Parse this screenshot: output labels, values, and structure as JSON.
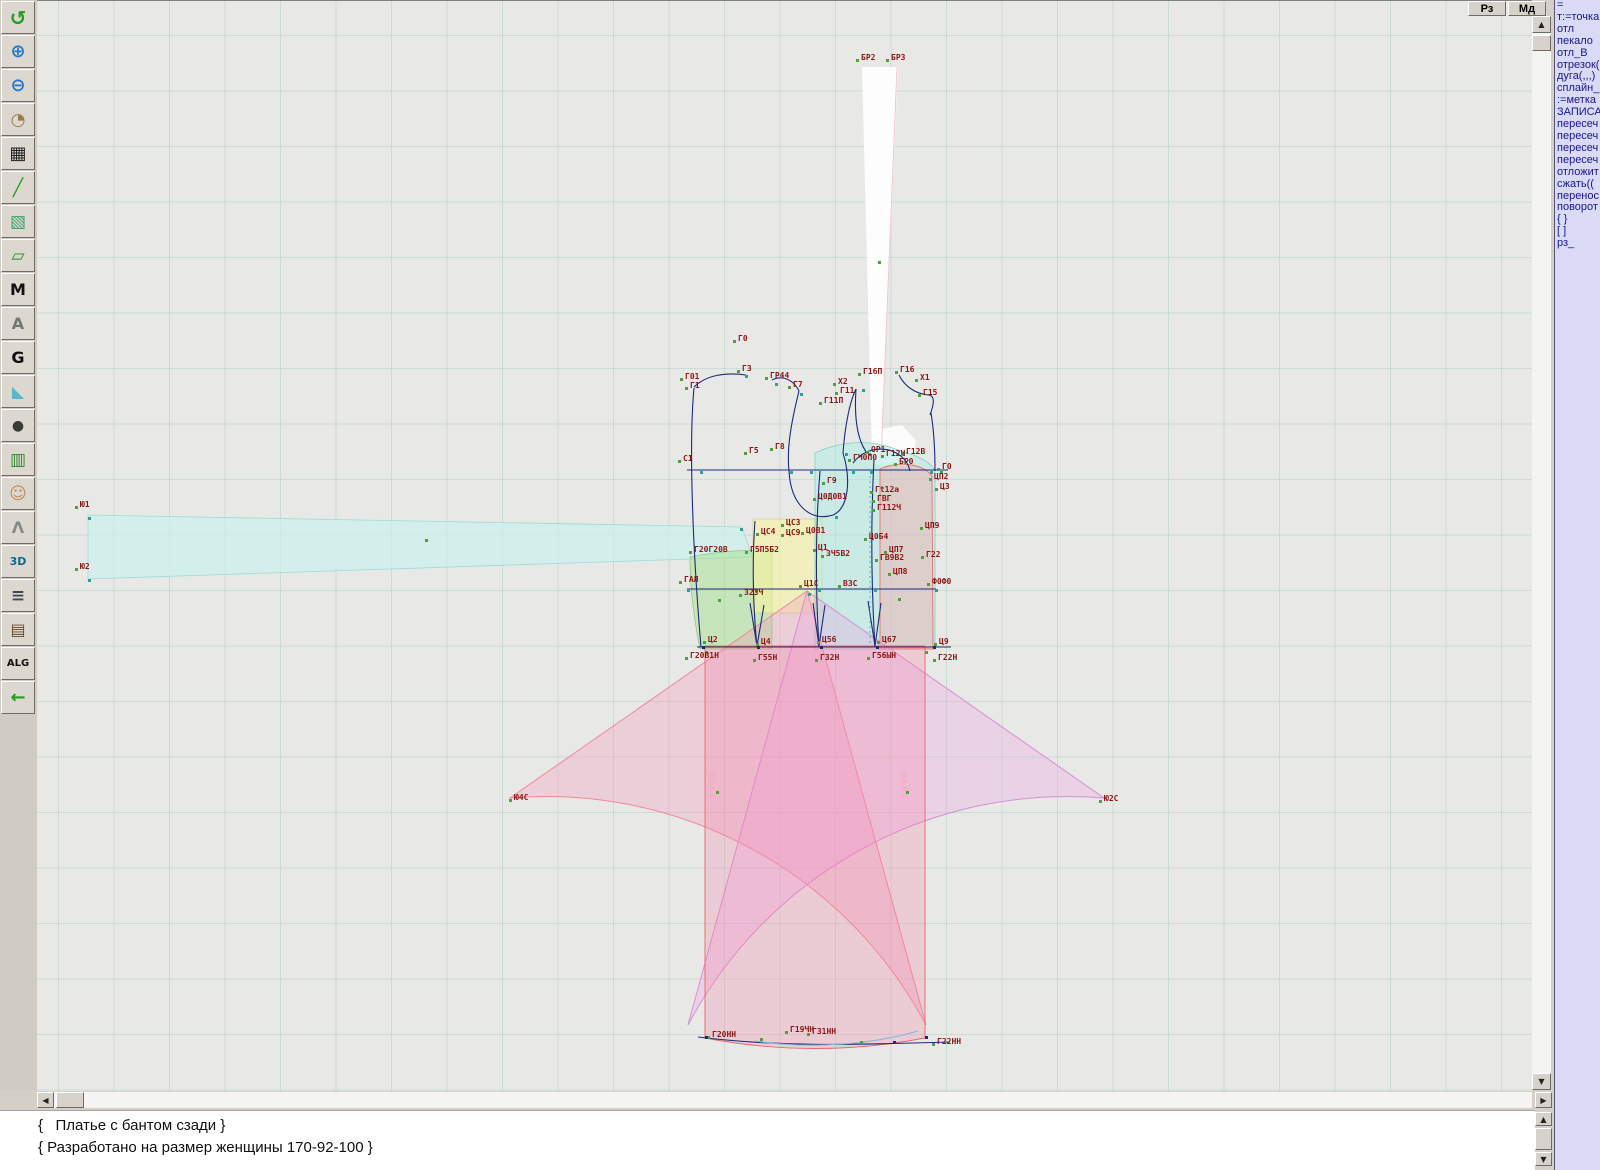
{
  "window": {
    "mode_buttons": [
      {
        "label": "Рз"
      },
      {
        "label": "Мд"
      }
    ]
  },
  "toolbar": {
    "items": [
      {
        "name": "refresh-icon",
        "glyph": "↺",
        "fg": "#1f9e1f",
        "size": 20
      },
      {
        "name": "zoom-in-icon",
        "glyph": "⊕",
        "fg": "#2277cc",
        "size": 18
      },
      {
        "name": "zoom-out-icon",
        "glyph": "⊖",
        "fg": "#2277cc",
        "size": 18
      },
      {
        "name": "zoom-piece-icon",
        "glyph": "◔",
        "fg": "#9a7b4f",
        "size": 17
      },
      {
        "name": "grid-icon",
        "glyph": "▦",
        "fg": "#222222",
        "size": 18
      },
      {
        "name": "measure-line-icon",
        "glyph": "╱",
        "fg": "#1f9e1f",
        "size": 17
      },
      {
        "name": "image-icon",
        "glyph": "▧",
        "fg": "#3aa06a",
        "size": 17
      },
      {
        "name": "pattern-piece-icon",
        "glyph": "▱",
        "fg": "#2a8a2a",
        "size": 17
      },
      {
        "name": "pattern-m-icon",
        "glyph": "M",
        "fg": "#111111",
        "size": 16
      },
      {
        "name": "compass-icon",
        "glyph": "A",
        "fg": "#777777",
        "size": 16
      },
      {
        "name": "g-tool-icon",
        "glyph": "G",
        "fg": "#111111",
        "size": 16
      },
      {
        "name": "ruler-icon",
        "glyph": "◣",
        "fg": "#58b8c8",
        "size": 16
      },
      {
        "name": "camera-icon",
        "glyph": "●",
        "fg": "#3a3a3a",
        "size": 14
      },
      {
        "name": "table-icon",
        "glyph": "▥",
        "fg": "#2a8a2a",
        "size": 17
      },
      {
        "name": "model-photo-icon",
        "glyph": "☺",
        "fg": "#c08a5a",
        "size": 17
      },
      {
        "name": "garment-icon",
        "glyph": "Λ",
        "fg": "#888888",
        "size": 16
      },
      {
        "name": "view-3d-icon",
        "glyph": "3D",
        "fg": "#0a6a8a",
        "size": 11
      },
      {
        "name": "text-list-icon",
        "glyph": "≡",
        "fg": "#444455",
        "size": 17
      },
      {
        "name": "books-icon",
        "glyph": "▤",
        "fg": "#6a4a2a",
        "size": 16
      },
      {
        "name": "alg-doc-icon",
        "glyph": "ALG",
        "fg": "#111111",
        "size": 10
      },
      {
        "name": "exit-icon",
        "glyph": "←",
        "fg": "#1f9e1f",
        "size": 18
      }
    ]
  },
  "command_panel": {
    "items": [
      "=",
      "т:=точка",
      "отл",
      "пекало",
      "отл_В",
      "отрезок(",
      "дуга(,,,)",
      "сплайн_",
      ":=метка",
      "ЗАПИСА",
      "пересеч",
      "пересеч",
      "пересеч",
      "пересеч",
      "отложит",
      "сжать((",
      "перенос",
      "поворот",
      "{ }",
      "[ ]",
      "рз_"
    ]
  },
  "statusbar": {
    "lines": [
      "{   Платье с бантом сзади }",
      "{ Разработано на размер женщины 170-92-100 }"
    ]
  },
  "canvas": {
    "colors": {
      "band_fill": "rgba(205,240,236,0.75)",
      "band_stroke": "#9adcd4",
      "green_fill": "rgba(160,225,130,0.45)",
      "green_stroke": "#8cc87c",
      "yellow_fill": "rgba(246,244,160,0.60)",
      "yellow_stroke": "#d8d28a",
      "cyan_fill": "rgba(175,235,228,0.55)",
      "cyan_stroke": "#88ccc4",
      "salmon_fill": "rgba(250,165,165,0.40)",
      "salmon_stroke": "#e87070",
      "fan_left_fill": "rgba(244,150,185,0.32)",
      "fan_left_stroke": "#ee8898",
      "fan_right_fill": "rgba(235,160,225,0.30)",
      "fan_right_stroke": "#d88ed0",
      "skirt_band_fill": "rgba(248,130,165,0.28)",
      "skirt_band_stroke": "#e86868",
      "outline": "#1c2a78",
      "white_piece": "#ffffff",
      "label_color": "#8c1616",
      "marker_green": "#4f9f3f",
      "marker_teal": "#2fa092",
      "dotted_teal": "#30b0b0",
      "hem_blue": "#80b8dc"
    },
    "labels": [
      {
        "x": 861,
        "y": 57,
        "t": "БР2"
      },
      {
        "x": 891,
        "y": 57,
        "t": "БР3"
      },
      {
        "x": 80,
        "y": 504,
        "t": "Ю1"
      },
      {
        "x": 80,
        "y": 566,
        "t": "Ю2"
      },
      {
        "x": 738,
        "y": 338,
        "t": "Г0"
      },
      {
        "x": 742,
        "y": 368,
        "t": "Г3"
      },
      {
        "x": 685,
        "y": 376,
        "t": "Г01"
      },
      {
        "x": 690,
        "y": 385,
        "t": "Г1"
      },
      {
        "x": 770,
        "y": 375,
        "t": "ГР44"
      },
      {
        "x": 793,
        "y": 384,
        "t": "Г7"
      },
      {
        "x": 838,
        "y": 381,
        "t": "Х2"
      },
      {
        "x": 840,
        "y": 390,
        "t": "Г11"
      },
      {
        "x": 863,
        "y": 371,
        "t": "Г16П"
      },
      {
        "x": 900,
        "y": 369,
        "t": "Г16"
      },
      {
        "x": 920,
        "y": 377,
        "t": "Х1"
      },
      {
        "x": 923,
        "y": 392,
        "t": "Г15"
      },
      {
        "x": 824,
        "y": 400,
        "t": "Г11П"
      },
      {
        "x": 775,
        "y": 446,
        "t": "Г8"
      },
      {
        "x": 749,
        "y": 450,
        "t": "Г5"
      },
      {
        "x": 683,
        "y": 458,
        "t": "С1"
      },
      {
        "x": 871,
        "y": 449,
        "t": "ОР1"
      },
      {
        "x": 853,
        "y": 457,
        "t": "ГЧ0П0"
      },
      {
        "x": 886,
        "y": 453,
        "t": "Г12Ч"
      },
      {
        "x": 906,
        "y": 451,
        "t": "Г12В"
      },
      {
        "x": 899,
        "y": 461,
        "t": "БР0"
      },
      {
        "x": 942,
        "y": 466,
        "t": "Г0"
      },
      {
        "x": 934,
        "y": 476,
        "t": "ЦП2"
      },
      {
        "x": 940,
        "y": 486,
        "t": "Ц3"
      },
      {
        "x": 827,
        "y": 480,
        "t": "Г9"
      },
      {
        "x": 818,
        "y": 496,
        "t": "Ц0Д0В1"
      },
      {
        "x": 875,
        "y": 489,
        "t": "Гt12а"
      },
      {
        "x": 877,
        "y": 498,
        "t": "ГВГ"
      },
      {
        "x": 877,
        "y": 507,
        "t": "Г112Ч"
      },
      {
        "x": 786,
        "y": 522,
        "t": "ЦС3"
      },
      {
        "x": 761,
        "y": 531,
        "t": "ЦС4"
      },
      {
        "x": 786,
        "y": 532,
        "t": "ЦС9"
      },
      {
        "x": 806,
        "y": 530,
        "t": "Ц0В1"
      },
      {
        "x": 925,
        "y": 525,
        "t": "ЦП9"
      },
      {
        "x": 869,
        "y": 536,
        "t": "Ц0Б4"
      },
      {
        "x": 694,
        "y": 549,
        "t": "Г20Г20В"
      },
      {
        "x": 750,
        "y": 549,
        "t": "Г5П5Б2"
      },
      {
        "x": 818,
        "y": 547,
        "t": "Ц1"
      },
      {
        "x": 826,
        "y": 553,
        "t": "ЗЧ5В2"
      },
      {
        "x": 889,
        "y": 549,
        "t": "ЦП7"
      },
      {
        "x": 880,
        "y": 557,
        "t": "ГВ9В2"
      },
      {
        "x": 926,
        "y": 554,
        "t": "Г22"
      },
      {
        "x": 893,
        "y": 571,
        "t": "ЦП8"
      },
      {
        "x": 684,
        "y": 579,
        "t": "ГАЛ"
      },
      {
        "x": 744,
        "y": 592,
        "t": "З2ЗЧ"
      },
      {
        "x": 804,
        "y": 583,
        "t": "Ц1С"
      },
      {
        "x": 843,
        "y": 583,
        "t": "ВЗС"
      },
      {
        "x": 932,
        "y": 581,
        "t": "Ф0Ф0"
      },
      {
        "x": 708,
        "y": 639,
        "t": "Ц2"
      },
      {
        "x": 761,
        "y": 641,
        "t": "Ц4"
      },
      {
        "x": 822,
        "y": 639,
        "t": "Ц56"
      },
      {
        "x": 882,
        "y": 639,
        "t": "Ц67"
      },
      {
        "x": 939,
        "y": 641,
        "t": "Ц9"
      },
      {
        "x": 690,
        "y": 655,
        "t": "Г20В1Н"
      },
      {
        "x": 758,
        "y": 657,
        "t": "Г55Н"
      },
      {
        "x": 820,
        "y": 657,
        "t": "Г32Н"
      },
      {
        "x": 872,
        "y": 655,
        "t": "Г56ЫН"
      },
      {
        "x": 938,
        "y": 657,
        "t": "Г22Н"
      },
      {
        "x": 514,
        "y": 797,
        "t": "Ю4С"
      },
      {
        "x": 1104,
        "y": 798,
        "t": "Ю2С"
      },
      {
        "x": 712,
        "y": 1034,
        "t": "Г20НН"
      },
      {
        "x": 790,
        "y": 1029,
        "t": "Г19ЧН"
      },
      {
        "x": 812,
        "y": 1031,
        "t": "Г31НН"
      },
      {
        "x": 937,
        "y": 1041,
        "t": "Г22НН"
      }
    ],
    "extra_markers": [
      {
        "x": 700,
        "y": 470,
        "c": "t"
      },
      {
        "x": 870,
        "y": 470,
        "c": "t"
      },
      {
        "x": 940,
        "y": 470,
        "c": "t"
      },
      {
        "x": 687,
        "y": 588,
        "c": "t"
      },
      {
        "x": 935,
        "y": 588,
        "c": "t"
      },
      {
        "x": 755,
        "y": 588,
        "c": "t"
      },
      {
        "x": 818,
        "y": 588,
        "c": "t"
      },
      {
        "x": 874,
        "y": 588,
        "c": "t"
      },
      {
        "x": 702,
        "y": 645,
        "c": "n"
      },
      {
        "x": 757,
        "y": 645,
        "c": "n"
      },
      {
        "x": 820,
        "y": 645,
        "c": "n"
      },
      {
        "x": 876,
        "y": 645,
        "c": "n"
      },
      {
        "x": 933,
        "y": 645,
        "c": "n"
      },
      {
        "x": 835,
        "y": 515,
        "c": "t"
      },
      {
        "x": 800,
        "y": 392,
        "c": "t"
      },
      {
        "x": 862,
        "y": 388,
        "c": "t"
      },
      {
        "x": 868,
        "y": 452,
        "c": "t"
      },
      {
        "x": 845,
        "y": 452,
        "c": "t"
      },
      {
        "x": 790,
        "y": 470,
        "c": "t"
      },
      {
        "x": 808,
        "y": 592,
        "c": "t"
      },
      {
        "x": 425,
        "y": 538,
        "c": "g"
      },
      {
        "x": 878,
        "y": 260,
        "c": "g"
      },
      {
        "x": 88,
        "y": 516,
        "c": "t"
      },
      {
        "x": 88,
        "y": 578,
        "c": "t"
      },
      {
        "x": 740,
        "y": 527,
        "c": "t"
      },
      {
        "x": 930,
        "y": 470,
        "c": "t"
      },
      {
        "x": 705,
        "y": 650,
        "c": "g"
      },
      {
        "x": 925,
        "y": 650,
        "c": "g"
      },
      {
        "x": 705,
        "y": 1035,
        "c": "n"
      },
      {
        "x": 925,
        "y": 1035,
        "c": "n"
      },
      {
        "x": 760,
        "y": 1037,
        "c": "g"
      },
      {
        "x": 860,
        "y": 1040,
        "c": "g"
      },
      {
        "x": 893,
        "y": 1040,
        "c": "n"
      },
      {
        "x": 852,
        "y": 470,
        "c": "t"
      },
      {
        "x": 810,
        "y": 470,
        "c": "t"
      },
      {
        "x": 745,
        "y": 374,
        "c": "t"
      },
      {
        "x": 775,
        "y": 382,
        "c": "t"
      },
      {
        "x": 718,
        "y": 598,
        "c": "g"
      },
      {
        "x": 898,
        "y": 597,
        "c": "g"
      },
      {
        "x": 716,
        "y": 790,
        "c": "g"
      },
      {
        "x": 906,
        "y": 790,
        "c": "g"
      }
    ],
    "vertical_texts": [
      {
        "x": 716,
        "y": 772,
        "t": "ЮБКА"
      },
      {
        "x": 908,
        "y": 772,
        "t": "ЮБКА"
      }
    ]
  }
}
